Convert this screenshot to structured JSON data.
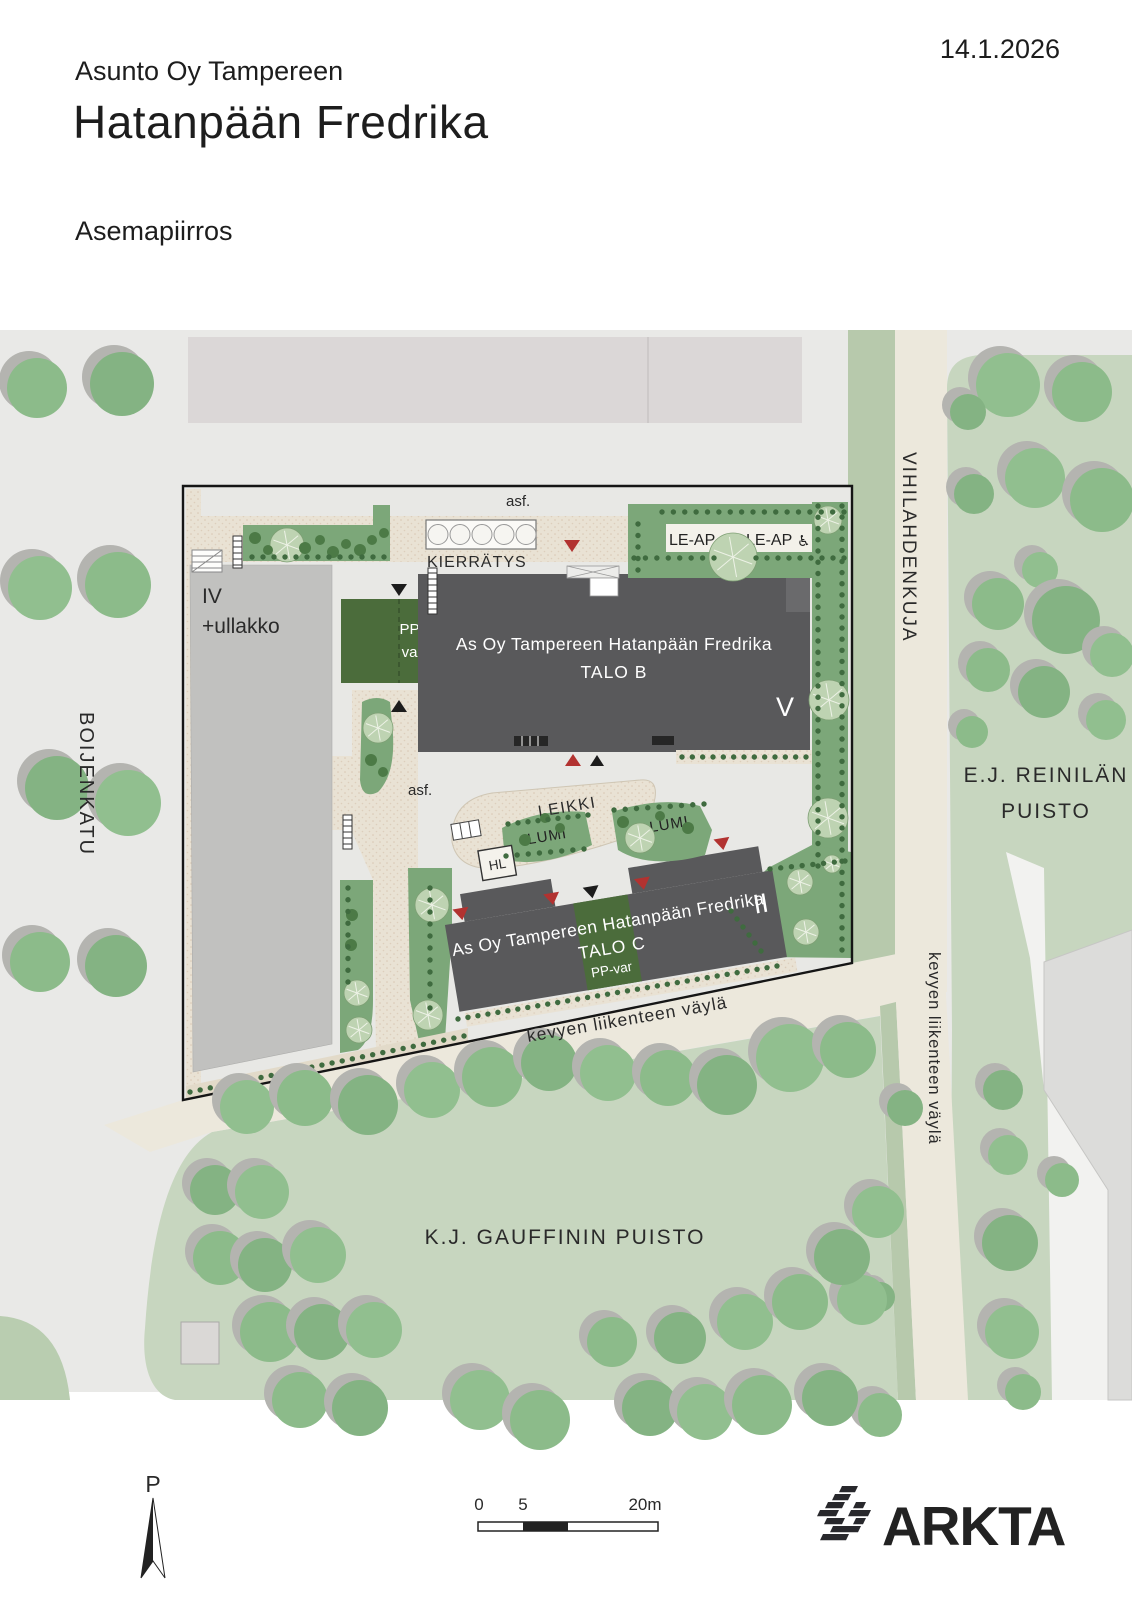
{
  "header": {
    "company": "Asunto Oy Tampereen",
    "title": "Hatanpään Fredrika",
    "subtitle": "Asemapiirros",
    "date": "14.1.2026"
  },
  "site": {
    "talo_b": {
      "line1": "As Oy Tampereen Hatanpään Fredrika",
      "line2": "TALO B",
      "floors": "V"
    },
    "talo_c": {
      "line1": "As Oy Tampereen Hatanpään Fredrika",
      "line2": "TALO C",
      "bike": "PP-var",
      "floors": "II"
    },
    "existing_building": {
      "floors": "IV",
      "attic": "+ullakko"
    },
    "bike_storage": {
      "line1": "PP-",
      "line2": "var"
    },
    "recycling": "KIERRÄTYS",
    "accessible_parking_1": "LE-AP",
    "accessible_parking_2": "LE-AP",
    "wheelchair_icon": "♿",
    "play_area": "LEIKKI",
    "snow_1": "LUMI",
    "snow_2": "LUMI",
    "bus_shelter": "HL",
    "asphalt_top": "asf.",
    "asphalt_mid": "asf."
  },
  "streets": {
    "west": "BOIJENKATU",
    "east": "VIHILAHDENKUJA",
    "path_south": "kevyen liikenteen väylä",
    "path_east": "kevyen liikenteen väylä"
  },
  "parks": {
    "east_line1": "E.J. REINILÄN",
    "east_line2": "PUISTO",
    "south": "K.J. GAUFFININ PUISTO"
  },
  "footer": {
    "north": "P",
    "scale": {
      "t0": "0",
      "t5": "5",
      "t20": "20m"
    },
    "logo": "ARKTA"
  },
  "colors": {
    "map_bg": "#e9e9e7",
    "site_bg": "#e8e8e5",
    "road": "#ece8dc",
    "paving": "#e9e2d4",
    "verge": "#b7c9ac",
    "park": "#c7d6bf",
    "tree": "#8bba89",
    "tree_shadow": "#b4b4b0",
    "planting": "#7ca779",
    "bush": "#3f6b3f",
    "building_new": "#59595b",
    "building_old": "#c1c1bf",
    "building_top": "#dbd7d7",
    "dark_green": "#4b6c3b",
    "accent_red": "#b23230",
    "ink": "#1c1c1c"
  }
}
